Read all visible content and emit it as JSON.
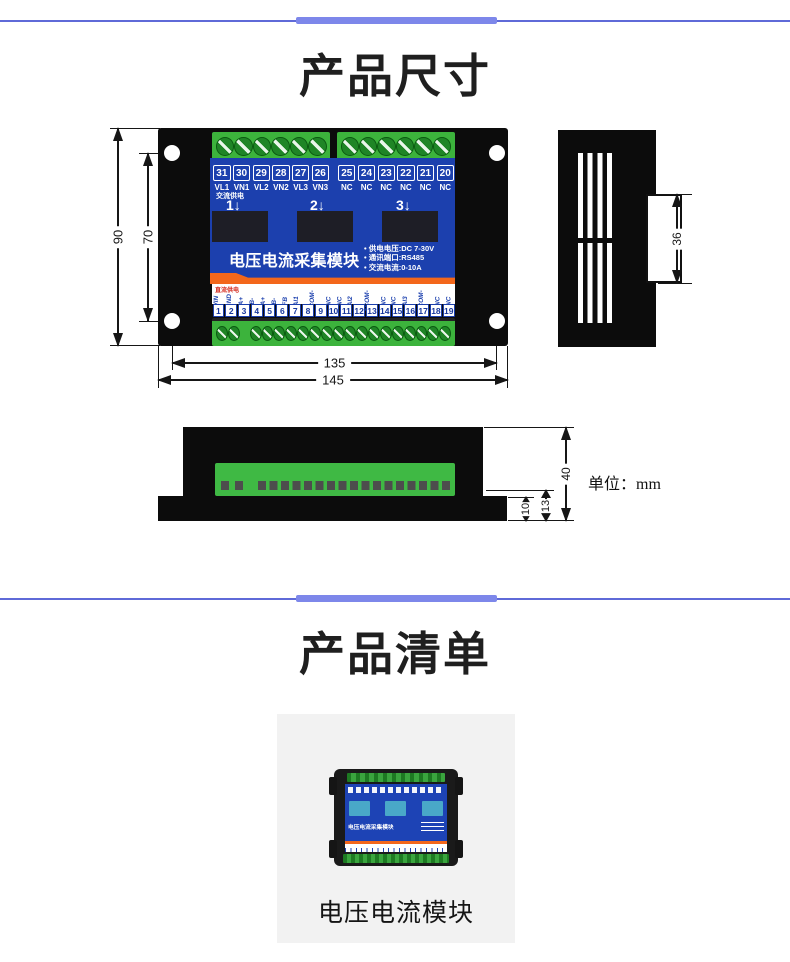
{
  "colors": {
    "divider": "#5f6ad8",
    "divider_center": "#7d87ea",
    "panel_blue": "#1c40ae",
    "terminal_green": "#3cb33c",
    "stripe_orange": "#f3671b",
    "device_black": "#0c0c0c"
  },
  "section_dimensions": {
    "title": "产品尺寸",
    "unit_label": "单位：mm"
  },
  "device": {
    "module_title": "电压电流采集模块",
    "specs": [
      "• 供电电压:DC 7-30V",
      "• 通讯端口:RS485",
      "• 交流电流:0-10A"
    ],
    "ac_power_label": "交流供电",
    "dc_power_label": "直流供电",
    "channel_labels": [
      "1↓",
      "2↓",
      "3↓"
    ],
    "top_terminals": [
      {
        "num": "31",
        "label": "VL1"
      },
      {
        "num": "30",
        "label": "VN1"
      },
      {
        "num": "29",
        "label": "VL2"
      },
      {
        "num": "28",
        "label": "VN2"
      },
      {
        "num": "27",
        "label": "VL3"
      },
      {
        "num": "26",
        "label": "VN3"
      },
      {
        "num": "25",
        "label": "NC"
      },
      {
        "num": "24",
        "label": "NC"
      },
      {
        "num": "23",
        "label": "NC"
      },
      {
        "num": "22",
        "label": "NC"
      },
      {
        "num": "21",
        "label": "NC"
      },
      {
        "num": "20",
        "label": "NC"
      }
    ],
    "bottom_terminals": [
      {
        "num": "1",
        "label": "VIN"
      },
      {
        "num": "2",
        "label": "GND"
      },
      {
        "num": "3",
        "label": "A+"
      },
      {
        "num": "4",
        "label": "B-"
      },
      {
        "num": "5",
        "label": "A+"
      },
      {
        "num": "6",
        "label": "B-"
      },
      {
        "num": "7",
        "label": "FB"
      },
      {
        "num": "8",
        "label": "AI1"
      },
      {
        "num": "9",
        "label": "ACOM-"
      },
      {
        "num": "10",
        "label": "NC"
      },
      {
        "num": "11",
        "label": "NC"
      },
      {
        "num": "12",
        "label": "AI2"
      },
      {
        "num": "13",
        "label": "ACOM-"
      },
      {
        "num": "14",
        "label": "NC"
      },
      {
        "num": "15",
        "label": "NC"
      },
      {
        "num": "16",
        "label": "AI3"
      },
      {
        "num": "17",
        "label": "ACOM-"
      },
      {
        "num": "18",
        "label": "NC"
      },
      {
        "num": "19",
        "label": "NC"
      }
    ]
  },
  "dimensions": {
    "height_outer": "90",
    "height_inner": "70",
    "width_inner": "135",
    "width_outer": "145",
    "side_clip": "36",
    "front_height": "40",
    "front_step": "13",
    "front_base": "10"
  },
  "section_list": {
    "title": "产品清单",
    "item_caption": "电压电流模块",
    "photo_title": "电压电流采集模块"
  }
}
